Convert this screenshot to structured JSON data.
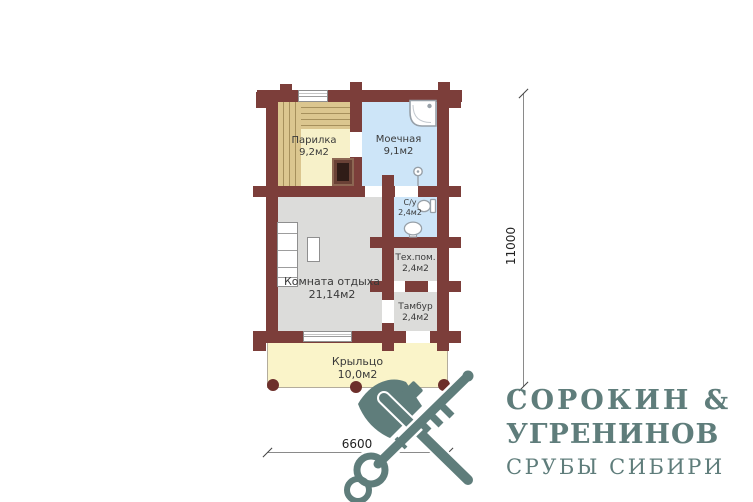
{
  "plan": {
    "title": "bath-house floor plan",
    "rooms": [
      {
        "id": "parilka",
        "name": "Парилка",
        "area": "9,2м2"
      },
      {
        "id": "moechnaya",
        "name": "Моечная",
        "area": "9,1м2"
      },
      {
        "id": "su",
        "name": "С/у",
        "area": "2,4м2"
      },
      {
        "id": "tehpom",
        "name": "Тех.пом.",
        "area": "2,4м2"
      },
      {
        "id": "tambur",
        "name": "Тамбур",
        "area": "2,4м2"
      },
      {
        "id": "komnata",
        "name": "Комната отдыха",
        "area": "21,14м2"
      },
      {
        "id": "krylco",
        "name": "Крыльцо",
        "area": "10,0м2"
      }
    ],
    "dimensions": {
      "height": "11000",
      "width": "6600"
    }
  },
  "logo": {
    "line1": "СОРОКИН &",
    "line2": "УГРЕНИНОВ",
    "line3": "СРУБЫ СИБИРИ",
    "mark": "axe-and-key-icon"
  },
  "colors": {
    "wall": "#7c3e3a",
    "accent": "#5f7d7b",
    "wet_room": "#cde5f8",
    "sauna_floor": "#f7f1c9",
    "bench_wood": "#dbc68f",
    "dry_room": "#dcdcda",
    "porch": "#faf4c9"
  }
}
